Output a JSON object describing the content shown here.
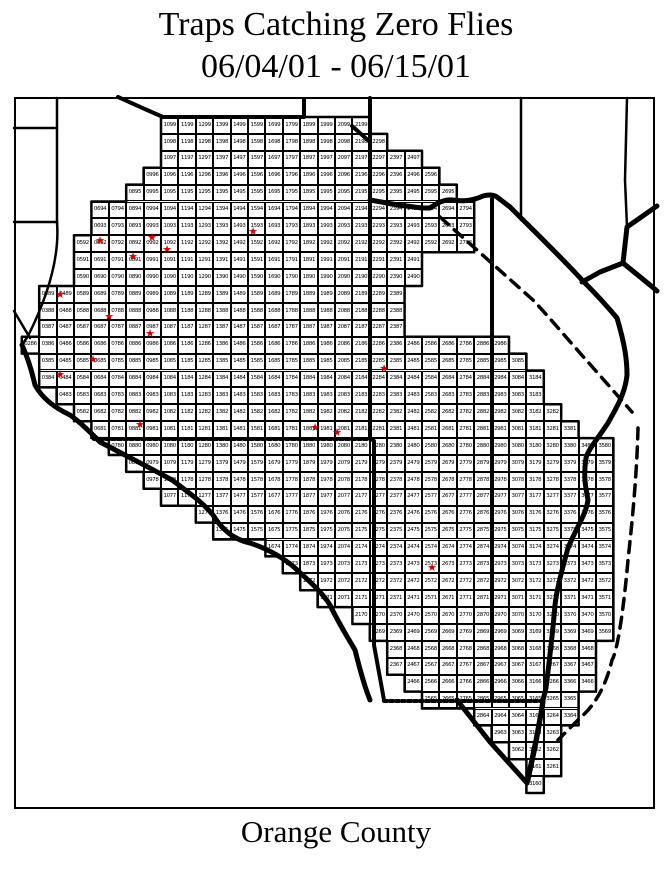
{
  "title": {
    "line1": "Traps Catching Zero Flies",
    "line2": "06/04/01 - 06/15/01"
  },
  "footer": {
    "label": "Orange County"
  },
  "map": {
    "region_label": "Orange County trap grid",
    "star_color": "#cc0000",
    "grid_rows": [
      {
        "row": 99,
        "col_start": 10,
        "col_end": 21
      },
      {
        "row": 98,
        "col_start": 10,
        "col_end": 22
      },
      {
        "row": 97,
        "col_start": 10,
        "col_end": 24
      },
      {
        "row": 96,
        "col_start": 9,
        "col_end": 25
      },
      {
        "row": 95,
        "col_start": 8,
        "col_end": 26
      },
      {
        "row": 94,
        "col_start": 6,
        "col_end": 27
      },
      {
        "row": 93,
        "col_start": 6,
        "col_end": 27
      },
      {
        "row": 92,
        "col_start": 5,
        "col_end": 27
      },
      {
        "row": 91,
        "col_start": 5,
        "col_end": 24
      },
      {
        "row": 90,
        "col_start": 5,
        "col_end": 24
      },
      {
        "row": 89,
        "col_start": 3,
        "col_end": 23
      },
      {
        "row": 88,
        "col_start": 3,
        "col_end": 23
      },
      {
        "row": 87,
        "col_start": 3,
        "col_end": 23
      },
      {
        "row": 86,
        "col_start": 2,
        "col_end": 29
      },
      {
        "row": 85,
        "col_start": 3,
        "col_end": 30
      },
      {
        "row": 84,
        "col_start": 3,
        "col_end": 31
      },
      {
        "row": 83,
        "col_start": 4,
        "col_end": 31
      },
      {
        "row": 82,
        "col_start": 5,
        "col_end": 32
      },
      {
        "row": 81,
        "col_start": 6,
        "col_end": 33
      },
      {
        "row": 80,
        "col_start": 7,
        "col_end": 35
      },
      {
        "row": 79,
        "col_start": 8,
        "col_end": 35
      },
      {
        "row": 78,
        "col_start": 9,
        "col_end": 35
      },
      {
        "row": 77,
        "col_start": 10,
        "col_end": 35
      },
      {
        "row": 76,
        "col_start": 12,
        "col_end": 35
      },
      {
        "row": 75,
        "col_start": 13,
        "col_end": 35
      },
      {
        "row": 74,
        "col_start": 16,
        "col_end": 35
      },
      {
        "row": 73,
        "col_start": 17,
        "col_end": 35
      },
      {
        "row": 72,
        "col_start": 18,
        "col_end": 35
      },
      {
        "row": 71,
        "col_start": 19,
        "col_end": 35
      },
      {
        "row": 70,
        "col_start": 21,
        "col_end": 35
      },
      {
        "row": 69,
        "col_start": 22,
        "col_end": 35
      },
      {
        "row": 68,
        "col_start": 23,
        "col_end": 34
      },
      {
        "row": 67,
        "col_start": 23,
        "col_end": 34
      },
      {
        "row": 66,
        "col_start": 24,
        "col_end": 34
      },
      {
        "row": 65,
        "col_start": 25,
        "col_end": 33
      },
      {
        "row": 64,
        "col_start": 28,
        "col_end": 33
      },
      {
        "row": 63,
        "col_start": 29,
        "col_end": 32
      },
      {
        "row": 62,
        "col_start": 30,
        "col_end": 32
      },
      {
        "row": 61,
        "col_start": 31,
        "col_end": 32
      },
      {
        "row": 60,
        "col_start": 31,
        "col_end": 31
      }
    ],
    "stars": [
      {
        "cell": "0692",
        "x": 100,
        "y": 241
      },
      {
        "cell": "0992",
        "x": 152,
        "y": 238
      },
      {
        "cell": "1592",
        "x": 253,
        "y": 232
      },
      {
        "cell": "0891",
        "x": 133,
        "y": 257
      },
      {
        "cell": "1091",
        "x": 167,
        "y": 250
      },
      {
        "cell": "0489",
        "x": 60,
        "y": 295
      },
      {
        "cell": "0788",
        "x": 109,
        "y": 317
      },
      {
        "cell": "0987",
        "x": 150,
        "y": 334
      },
      {
        "cell": "0685",
        "x": 93,
        "y": 360
      },
      {
        "cell": "0484",
        "x": 60,
        "y": 375
      },
      {
        "cell": "2384",
        "x": 384,
        "y": 369
      },
      {
        "cell": "0981",
        "x": 140,
        "y": 425
      },
      {
        "cell": "1981",
        "x": 315,
        "y": 428
      },
      {
        "cell": "2081",
        "x": 337,
        "y": 433
      },
      {
        "cell": "2573",
        "x": 432,
        "y": 568
      }
    ]
  }
}
